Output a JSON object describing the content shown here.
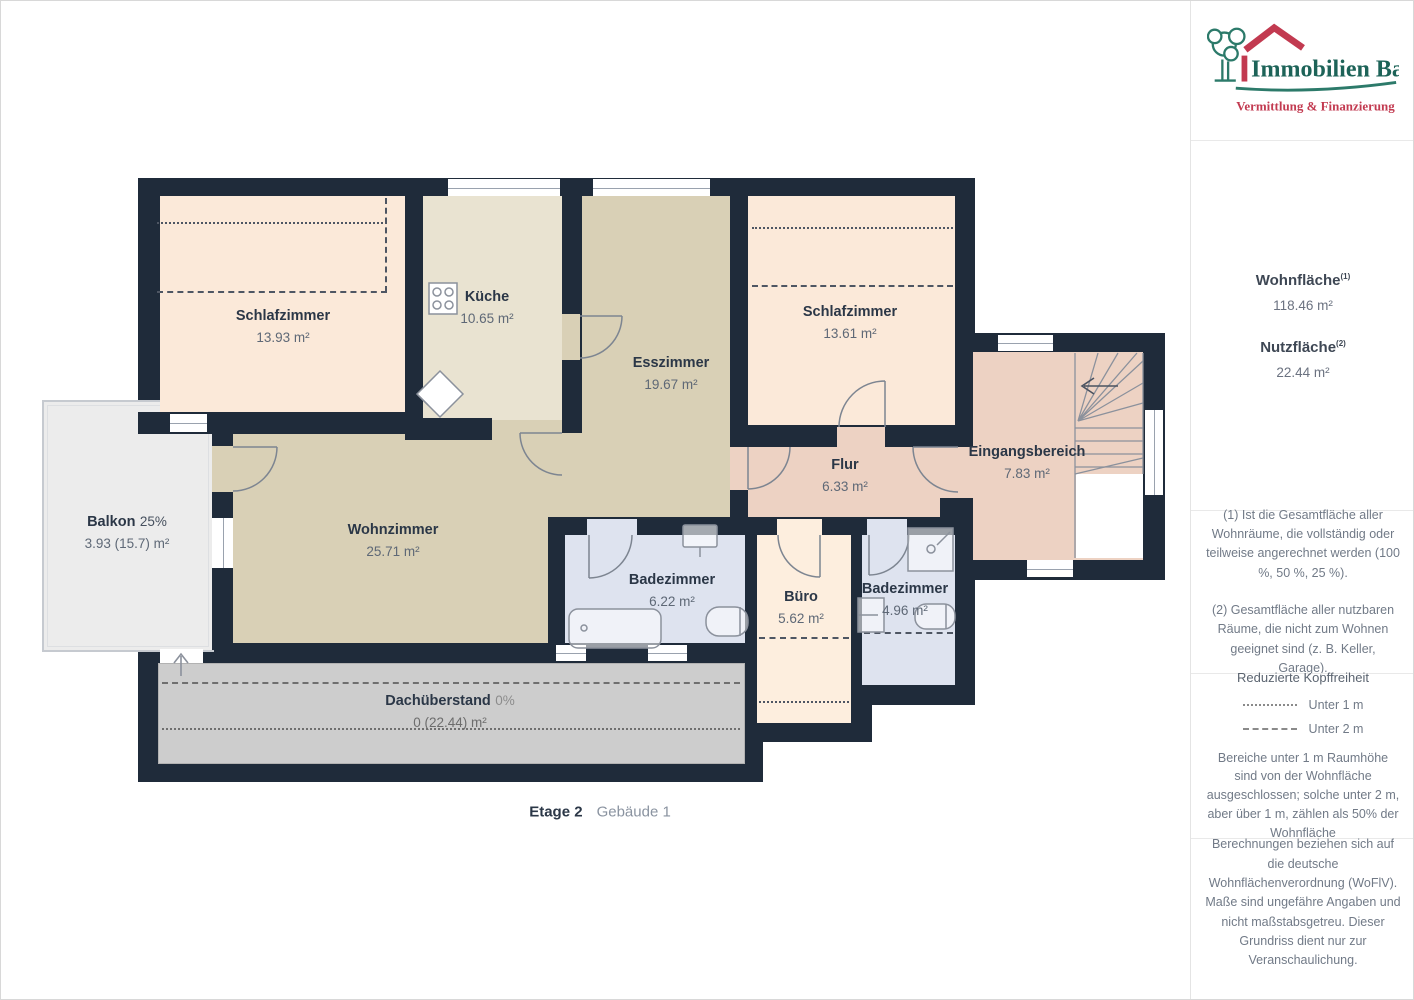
{
  "floorplan": {
    "caption": {
      "floor": "Etage 2",
      "building": "Gebäude 1"
    },
    "rooms": [
      {
        "id": "schlafzimmer-links",
        "name": "Schlafzimmer",
        "area": "13.93 m²"
      },
      {
        "id": "kueche",
        "name": "Küche",
        "area": "10.65 m²"
      },
      {
        "id": "esszimmer",
        "name": "Esszimmer",
        "area": "19.67 m²"
      },
      {
        "id": "schlafzimmer-rechts",
        "name": "Schlafzimmer",
        "area": "13.61 m²"
      },
      {
        "id": "balkon",
        "name": "Balkon",
        "percent": "25%",
        "area": "3.93 (15.7) m²"
      },
      {
        "id": "wohnzimmer",
        "name": "Wohnzimmer",
        "area": "25.71 m²"
      },
      {
        "id": "badezimmer-1",
        "name": "Badezimmer",
        "area": "6.22 m²"
      },
      {
        "id": "buero",
        "name": "Büro",
        "area": "5.62 m²"
      },
      {
        "id": "badezimmer-2",
        "name": "Badezimmer",
        "area": "4.96 m²"
      },
      {
        "id": "flur",
        "name": "Flur",
        "area": "6.33 m²"
      },
      {
        "id": "eingangsbereich",
        "name": "Eingangsbereich",
        "area": "7.83 m²"
      },
      {
        "id": "dachueberstand",
        "name": "Dachüberstand",
        "percent": "0%",
        "area": "0 (22.44) m²"
      }
    ],
    "colors": {
      "wall": "#1f2b3a",
      "bedroom": "#fbe9d9",
      "kitchen": "#e9e3d1",
      "living": "#d9d0b6",
      "hall": "#edd2c3",
      "bath": "#dee3ef",
      "office": "#fdeede",
      "balcony": "#ececec",
      "overhang": "#cdcdcd"
    }
  },
  "sidebar": {
    "logo": {
      "title": "Immobilien Bart",
      "subtitle": "Vermittlung & Finanzierung",
      "colors": {
        "green": "#2c7a6a",
        "red": "#c23a50"
      }
    },
    "metrics": [
      {
        "label": "Wohnfläche",
        "sup": "(1)",
        "value": "118.46 m²"
      },
      {
        "label": "Nutzfläche",
        "sup": "(2)",
        "value": "22.44 m²"
      }
    ],
    "notes": [
      "(1) Ist die Gesamtfläche aller Wohnräume, die vollständig oder teilweise angerechnet werden (100 %, 50 %, 25 %).",
      "(2) Gesamtfläche aller nutzbaren Räume, die nicht zum Wohnen geeignet sind (z. B. Keller, Garage)."
    ],
    "headroom": {
      "title": "Reduzierte Kopffreiheit",
      "legend": [
        {
          "label": "Unter 1 m",
          "style": "dotted"
        },
        {
          "label": "Unter 2 m",
          "style": "dashed"
        }
      ],
      "body": "Bereiche unter 1 m Raumhöhe sind von der Wohnfläche ausgeschlossen; solche unter 2 m, aber über 1 m, zählen als 50% der Wohnfläche"
    },
    "disclaimer": "Berechnungen beziehen sich auf die deutsche Wohnflächenverordnung (WoFlV). Maße sind ungefähre Angaben und nicht maßstabsgetreu. Dieser Grundriss dient nur zur Veranschaulichung.",
    "brand": {
      "name": "GIRAFFE",
      "suffix": "360"
    }
  }
}
